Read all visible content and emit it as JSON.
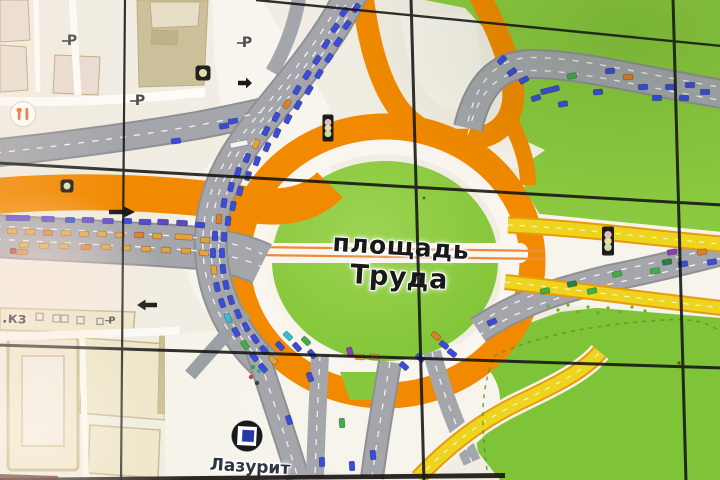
{
  "screen": {
    "description_labels": {
      "square_line1": "площадь",
      "square_line2": "Труда",
      "store": "Лазурит",
      "street_fragment": ".кз",
      "parking_letter": "P"
    },
    "colors": {
      "car_blue": "#3A4CD8",
      "car_purple_bus": "#5B49CC",
      "car_yellow": "#E5A23B",
      "car_orange": "#DF7F28",
      "car_green": "#3FAF43",
      "car_dark_green": "#2D7F3F",
      "car_cyan": "#35BFD4",
      "car_violet": "#8A3FB0",
      "car_red": "#C03227",
      "car_white": "#F4F4F2",
      "road_orange": "#F18A00",
      "road_yellow": "#EDD41F",
      "road_gray": "#A4A6AC",
      "park_green": "#8BCA40",
      "bg_cream": "#F1EDE2"
    },
    "cars": [
      [
        356,
        8,
        -52,
        "b"
      ],
      [
        344,
        12,
        -52,
        "b"
      ],
      [
        347,
        25,
        -54,
        "b"
      ],
      [
        335,
        28,
        -54,
        "b"
      ],
      [
        338,
        42,
        -55,
        "b"
      ],
      [
        326,
        44,
        -55,
        "b"
      ],
      [
        329,
        58,
        -56,
        "b"
      ],
      [
        317,
        60,
        -56,
        "b"
      ],
      [
        319,
        74,
        -58,
        "b"
      ],
      [
        307,
        75,
        -58,
        "b"
      ],
      [
        309,
        90,
        -60,
        "b"
      ],
      [
        297,
        90,
        -60,
        "b"
      ],
      [
        298,
        105,
        -61,
        "b"
      ],
      [
        287,
        104,
        -61,
        "o"
      ],
      [
        288,
        119,
        -63,
        "b"
      ],
      [
        276,
        117,
        -63,
        "b"
      ],
      [
        277,
        133,
        -65,
        "b"
      ],
      [
        266,
        131,
        -65,
        "b"
      ],
      [
        267,
        147,
        -67,
        "b"
      ],
      [
        256,
        144,
        -67,
        "y"
      ],
      [
        257,
        161,
        -70,
        "b"
      ],
      [
        247,
        158,
        -70,
        "b"
      ],
      [
        248,
        176,
        -73,
        "b"
      ],
      [
        238,
        172,
        -73,
        "b"
      ],
      [
        240,
        191,
        -77,
        "b"
      ],
      [
        231,
        187,
        -77,
        "b"
      ],
      [
        233,
        206,
        -80,
        "b"
      ],
      [
        224,
        203,
        -80,
        "b"
      ],
      [
        228,
        221,
        -84,
        "b"
      ],
      [
        219,
        219,
        -84,
        "o"
      ],
      [
        224,
        237,
        -88,
        "b"
      ],
      [
        215,
        236,
        -88,
        "b"
      ],
      [
        222,
        253,
        88,
        "b"
      ],
      [
        213,
        253,
        88,
        "b"
      ],
      [
        223,
        269,
        84,
        "b"
      ],
      [
        214,
        270,
        84,
        "y"
      ],
      [
        226,
        285,
        78,
        "b"
      ],
      [
        217,
        287,
        78,
        "b"
      ],
      [
        231,
        300,
        72,
        "b"
      ],
      [
        222,
        303,
        72,
        "b"
      ],
      [
        238,
        314,
        66,
        "b"
      ],
      [
        228,
        318,
        66,
        "c"
      ],
      [
        246,
        327,
        60,
        "b"
      ],
      [
        236,
        332,
        60,
        "b"
      ],
      [
        255,
        339,
        55,
        "b"
      ],
      [
        245,
        345,
        55,
        "g"
      ],
      [
        264,
        350,
        51,
        "b"
      ],
      [
        254,
        357,
        51,
        "b"
      ],
      [
        273,
        360,
        48,
        "y"
      ],
      [
        263,
        368,
        48,
        "b"
      ],
      [
        176,
        141,
        -7,
        "b"
      ],
      [
        224,
        126,
        -10,
        "b"
      ],
      [
        233,
        121,
        -11,
        "b"
      ],
      [
        239,
        144,
        -11,
        "w",
        18
      ],
      [
        18,
        218,
        1,
        "p",
        24
      ],
      [
        48,
        219,
        1,
        "p",
        13
      ],
      [
        70,
        220,
        1,
        "b"
      ],
      [
        88,
        220,
        1,
        "p",
        12
      ],
      [
        108,
        221,
        1,
        "p",
        11
      ],
      [
        127,
        221,
        2,
        "b"
      ],
      [
        145,
        222,
        2,
        "p",
        12
      ],
      [
        163,
        222,
        2,
        "p",
        11
      ],
      [
        182,
        223,
        3,
        "p",
        11
      ],
      [
        200,
        225,
        4,
        "b"
      ],
      [
        12,
        231,
        1,
        "y"
      ],
      [
        30,
        232,
        1,
        "y"
      ],
      [
        48,
        233,
        1,
        "o"
      ],
      [
        66,
        233,
        1,
        "y"
      ],
      [
        84,
        234,
        1,
        "y"
      ],
      [
        102,
        234,
        1,
        "y"
      ],
      [
        120,
        235,
        2,
        "y"
      ],
      [
        139,
        235,
        2,
        "o"
      ],
      [
        157,
        236,
        2,
        "y"
      ],
      [
        184,
        237,
        3,
        "y",
        18
      ],
      [
        205,
        240,
        6,
        "y"
      ],
      [
        24,
        245,
        1,
        "y"
      ],
      [
        44,
        246,
        1,
        "y"
      ],
      [
        64,
        246,
        1,
        "y"
      ],
      [
        86,
        247,
        1,
        "o"
      ],
      [
        106,
        247,
        1,
        "y"
      ],
      [
        126,
        248,
        2,
        "y"
      ],
      [
        146,
        249,
        2,
        "y"
      ],
      [
        166,
        250,
        2,
        "y"
      ],
      [
        186,
        251,
        3,
        "y"
      ],
      [
        204,
        253,
        6,
        "y"
      ],
      [
        22,
        252,
        1,
        "o",
        11
      ],
      [
        13,
        251,
        1,
        "r",
        6
      ],
      [
        288,
        336,
        45,
        "c"
      ],
      [
        280,
        346,
        47,
        "b"
      ],
      [
        297,
        347,
        48,
        "b"
      ],
      [
        306,
        341,
        45,
        "g"
      ],
      [
        312,
        354,
        50,
        "b"
      ],
      [
        350,
        352,
        75,
        "v"
      ],
      [
        360,
        357,
        2,
        "y"
      ],
      [
        374,
        357,
        2,
        "y"
      ],
      [
        436,
        336,
        38,
        "o"
      ],
      [
        444,
        345,
        38,
        "b"
      ],
      [
        452,
        353,
        38,
        "b"
      ],
      [
        420,
        358,
        40,
        "b"
      ],
      [
        404,
        366,
        42,
        "b"
      ],
      [
        310,
        377,
        70,
        "b"
      ],
      [
        289,
        420,
        72,
        "b"
      ],
      [
        342,
        423,
        86,
        "g"
      ],
      [
        322,
        462,
        88,
        "b"
      ],
      [
        352,
        466,
        86,
        "b"
      ],
      [
        373,
        455,
        85,
        "b"
      ],
      [
        492,
        322,
        -22,
        "b"
      ],
      [
        545,
        291,
        -12,
        "g"
      ],
      [
        572,
        284,
        -11,
        "dg"
      ],
      [
        592,
        291,
        -11,
        "g"
      ],
      [
        617,
        274,
        -11,
        "g"
      ],
      [
        655,
        271,
        -10,
        "g"
      ],
      [
        667,
        262,
        -10,
        "dg"
      ],
      [
        683,
        264,
        -9,
        "b"
      ],
      [
        672,
        252,
        -10,
        "v"
      ],
      [
        702,
        252,
        -9,
        "o"
      ],
      [
        712,
        262,
        -9,
        "b"
      ],
      [
        502,
        60,
        -45,
        "b"
      ],
      [
        512,
        72,
        -35,
        "b"
      ],
      [
        524,
        80,
        -28,
        "b"
      ],
      [
        536,
        98,
        -18,
        "b"
      ],
      [
        550,
        90,
        -14,
        "b",
        19
      ],
      [
        563,
        104,
        -10,
        "b"
      ],
      [
        572,
        76,
        -9,
        "g"
      ],
      [
        598,
        92,
        -6,
        "b"
      ],
      [
        610,
        71,
        -5,
        "b"
      ],
      [
        628,
        77,
        -3,
        "o"
      ],
      [
        643,
        87,
        -2,
        "b"
      ],
      [
        657,
        98,
        -1,
        "b"
      ],
      [
        670,
        87,
        0,
        "b"
      ],
      [
        684,
        98,
        0,
        "b"
      ],
      [
        690,
        85,
        1,
        "b"
      ],
      [
        705,
        92,
        1,
        "b"
      ]
    ],
    "traffic_lights": [
      {
        "x": 328,
        "y": 128,
        "w": 11,
        "h": 27
      },
      {
        "x": 608,
        "y": 241,
        "w": 12,
        "h": 29
      }
    ],
    "speed_cameras": [
      {
        "x": 203,
        "y": 73,
        "s": 15
      },
      {
        "x": 67,
        "y": 186,
        "s": 13
      }
    ],
    "parking_markers": [
      {
        "x": 72,
        "y": 40,
        "s": 1
      },
      {
        "x": 140,
        "y": 100,
        "s": 1
      },
      {
        "x": 247,
        "y": 42,
        "s": 1
      },
      {
        "x": 112,
        "y": 320,
        "s": 0.7
      }
    ],
    "direction_arrows": [
      {
        "x": 122,
        "y": 212,
        "dir": "right",
        "s": 13
      },
      {
        "x": 147,
        "y": 305,
        "dir": "left",
        "s": 10
      },
      {
        "x": 245,
        "y": 83,
        "dir": "right",
        "s": 7
      }
    ],
    "pedestrian_dots": [
      {
        "x": 251,
        "y": 377,
        "c": "#C04433"
      },
      {
        "x": 253,
        "y": 367,
        "c": "#3AA055"
      },
      {
        "x": 259,
        "y": 371,
        "c": "#2AAFA5"
      },
      {
        "x": 257,
        "y": 383,
        "c": "#334455"
      }
    ]
  }
}
